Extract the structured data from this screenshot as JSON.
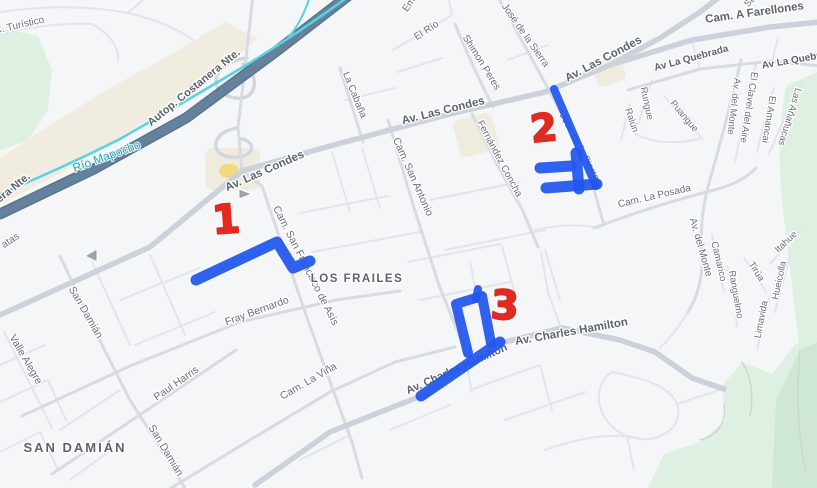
{
  "areas": {
    "san_damian": "SAN DAMIÁN",
    "los_frailes": "LOS FRAILES"
  },
  "water": {
    "rio_mapocho": "Río Mapocho"
  },
  "streets": {
    "autop_costanera_nte": "Autop. Costanera Nte.",
    "c_turistico": "C. Turístico",
    "av_las_condes": "Av. Las Condes",
    "cam_a_farellones": "Cam. A Farellones",
    "el_rio": "El Río",
    "shimon_peres": "Shimon Peres",
    "jose_de_la_sierra": "José de la Sierra",
    "la_cabana": "La Cabaña",
    "emanuel_fragment": "Ema",
    "sa_fragment": "Sa",
    "av_la_quebrada": "Av La Quebrada",
    "rungue": "Rungue",
    "ralun": "Ralún",
    "puangue": "Puangue",
    "cam_la_posada": "Cam. La Posada",
    "av_del_monte": "Av. del Monte",
    "el_clavel_del_aire": "El Clavel del Aire",
    "el_amancai": "El Amancai",
    "las_ananucas": "Las Añañucas",
    "camarico": "Camarico",
    "ranguelmo": "Ranguelmo",
    "tirua": "Tirúa",
    "itahue": "Itahue",
    "hueicolla": "Hueicolla",
    "limavida": "Limavida",
    "fernandez_concha": "Fernández Concha",
    "cam_san_antonio": "Cam. San Antonio",
    "cam_san_francisco_de_asis": "Cam. San Francisco de Asís",
    "fray_bernardo": "Fray Bernardo",
    "cam_la_vina": "Cam. La Viña",
    "av_charles_hamilton": "Av. Charles Hamilton",
    "san_damian": "San Damián",
    "valle_alegre": "Valle Alegre",
    "paul_harris": "Paul Harris",
    "edge_fragment_atas": "atas"
  },
  "annotations": {
    "marker_1": "1",
    "marker_2": "2",
    "marker_3": "3"
  },
  "colors": {
    "annotation_blue": "#2056ee",
    "annotation_red": "#e02b20",
    "water": "#59d2e2",
    "water_label": "#2aa6c0",
    "highway": "#66819c",
    "highway_casing": "#597590",
    "park_green": "#def0e2",
    "park_green_dark": "#cfe7d5",
    "terrain_beige": "#f0ecdd",
    "poi_yellow": "#f2d66d"
  }
}
